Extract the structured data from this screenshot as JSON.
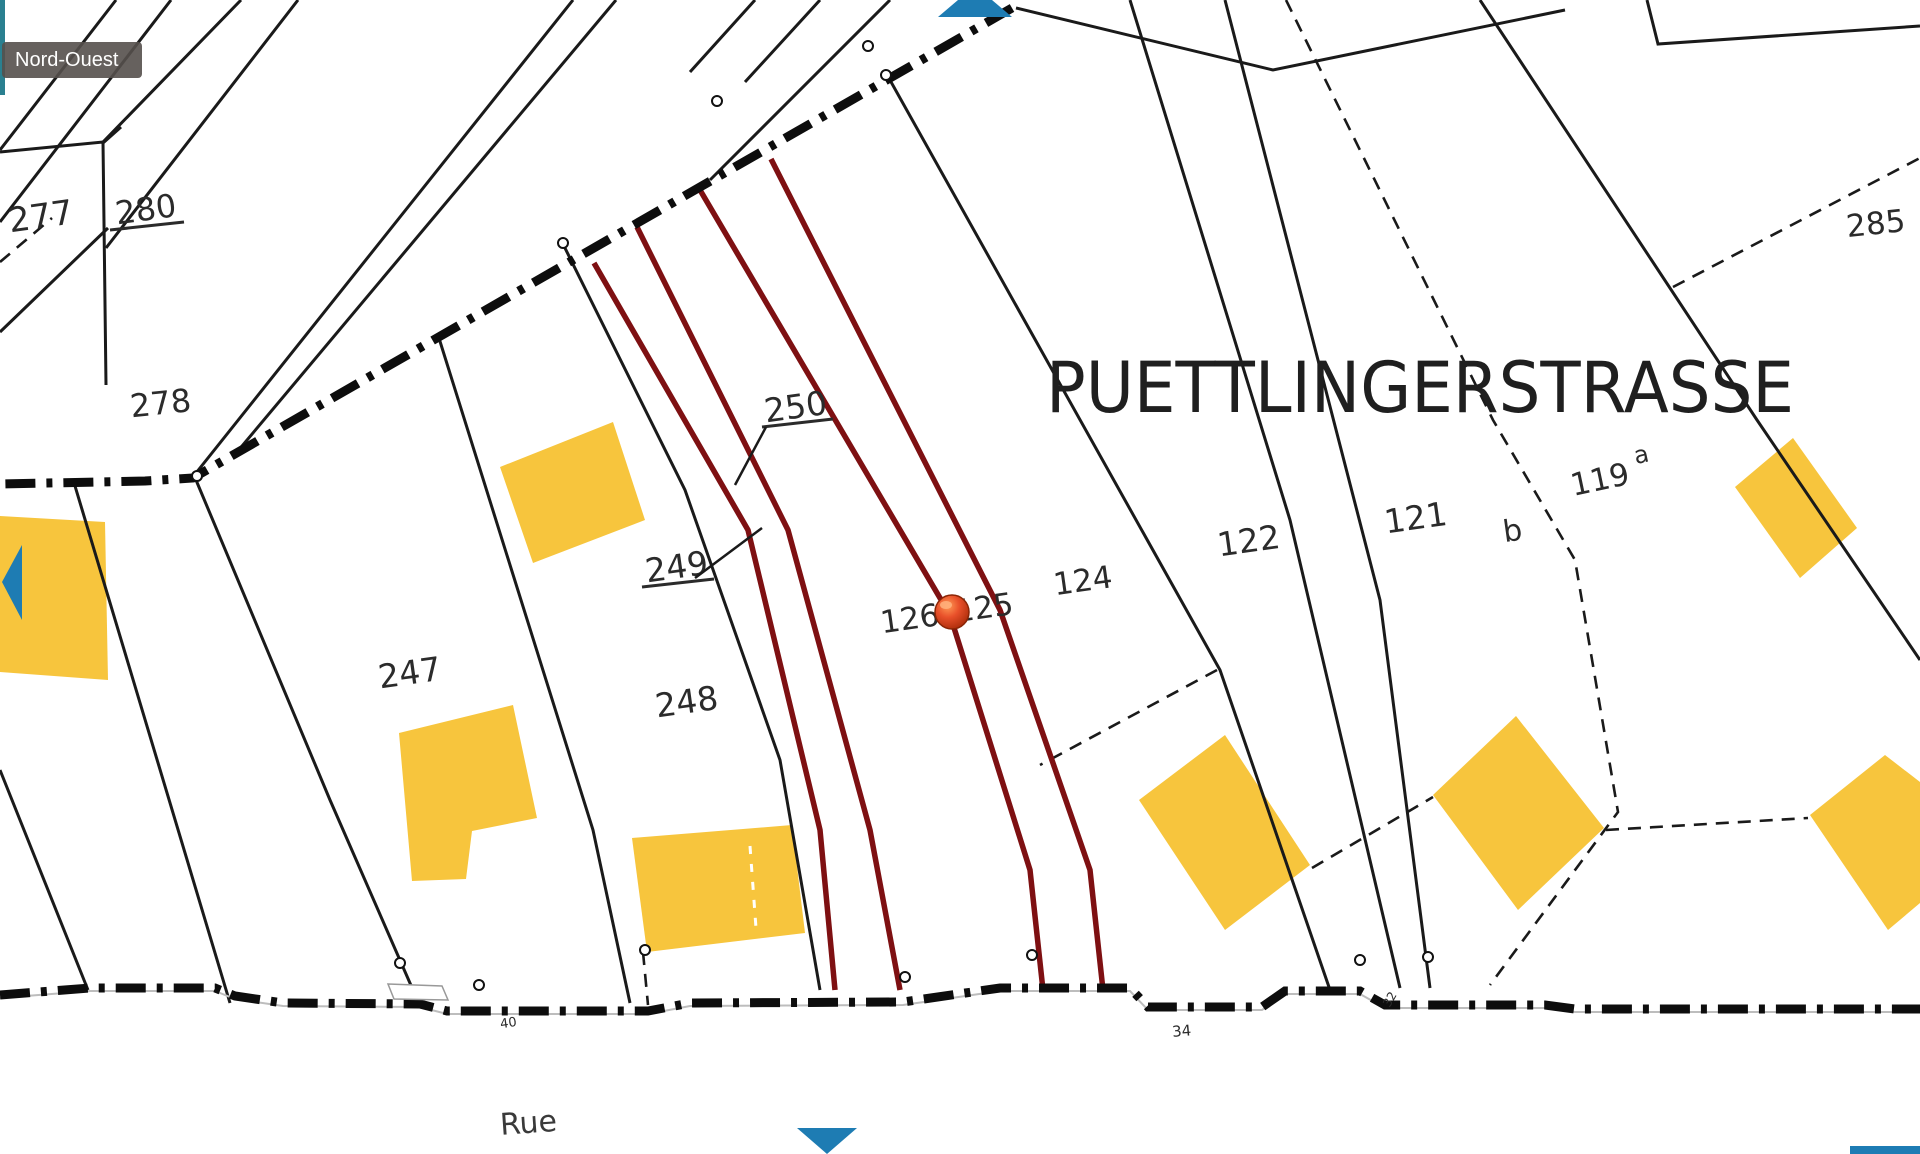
{
  "tooltip": {
    "text": "Nord-Ouest"
  },
  "map": {
    "street_main": "PUETTLINGERSTRASSE",
    "street_bottom": "Rue",
    "parcels": [
      {
        "id": "277",
        "text": "277"
      },
      {
        "id": "280",
        "text": "280",
        "underlined": true
      },
      {
        "id": "278",
        "text": "278"
      },
      {
        "id": "247",
        "text": "247"
      },
      {
        "id": "248",
        "text": "248"
      },
      {
        "id": "249",
        "text": "249",
        "underlined": true
      },
      {
        "id": "250",
        "text": "250",
        "underlined": true
      },
      {
        "id": "126",
        "text": "126"
      },
      {
        "id": "125",
        "text": "125"
      },
      {
        "id": "124",
        "text": "124"
      },
      {
        "id": "122",
        "text": "122"
      },
      {
        "id": "121",
        "text": "121"
      },
      {
        "id": "b",
        "text": "b"
      },
      {
        "id": "119a",
        "text": "119",
        "sup": "a"
      },
      {
        "id": "285",
        "text": "285"
      }
    ],
    "measurements": [
      {
        "text": "40"
      },
      {
        "text": "34"
      },
      {
        "text": "32"
      }
    ]
  },
  "nav": {
    "arrows": [
      {
        "name": "pan-up-arrow"
      },
      {
        "name": "pan-left-arrow"
      },
      {
        "name": "pan-down-arrow"
      }
    ]
  },
  "colors": {
    "highlight_line": "#7E1012",
    "building": "#F7C53D",
    "arrow_blue": "#1E7CB3",
    "boundary": "#0d0d0d",
    "tooltip_bg": "#55504C",
    "marker": "#D9441C"
  }
}
